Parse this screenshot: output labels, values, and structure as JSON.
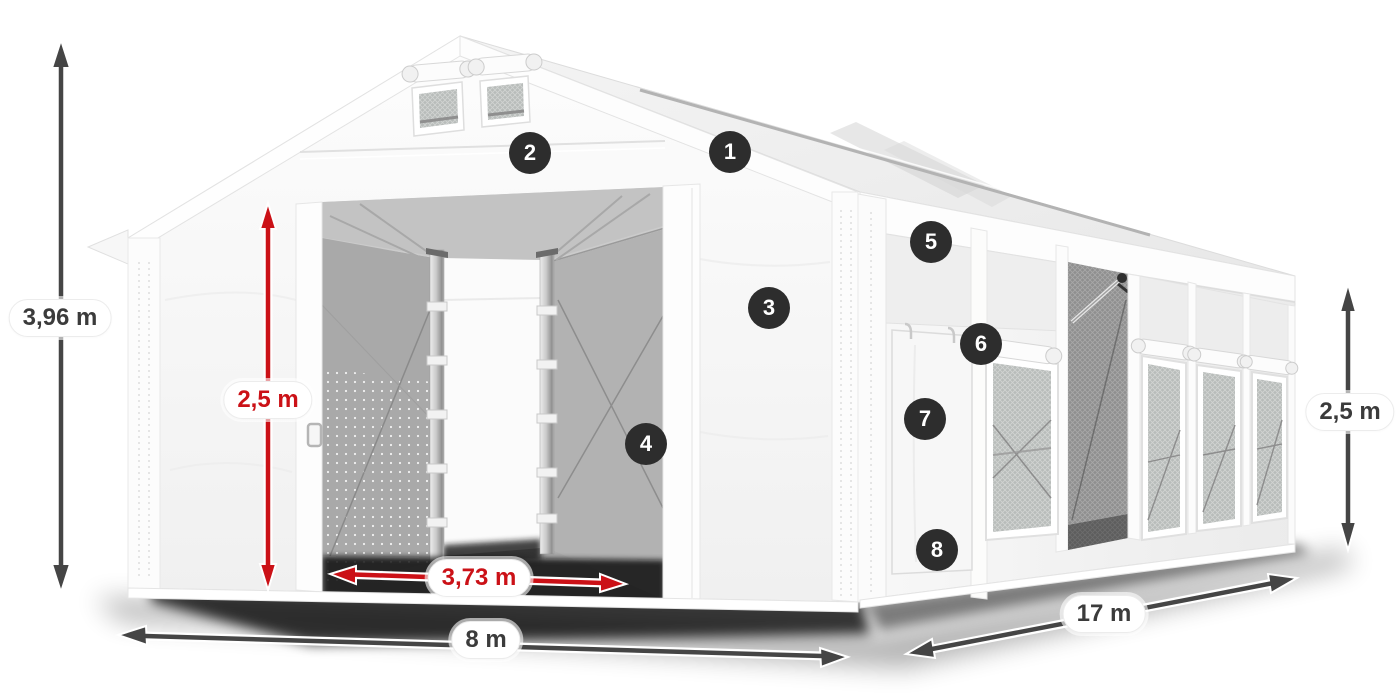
{
  "dimensions": {
    "total_height": "3,96 m",
    "door_height": "2,5 m",
    "door_width": "3,73 m",
    "front_width": "8 m",
    "length": "17 m",
    "side_height": "2,5 m"
  },
  "markers": [
    "1",
    "2",
    "3",
    "4",
    "5",
    "6",
    "7",
    "8"
  ],
  "colors": {
    "dimension_red": "#cb1117",
    "dimension_dark": "#454545",
    "marker_background": "#2d2d2d",
    "tent_white": "#f7f7f7"
  }
}
